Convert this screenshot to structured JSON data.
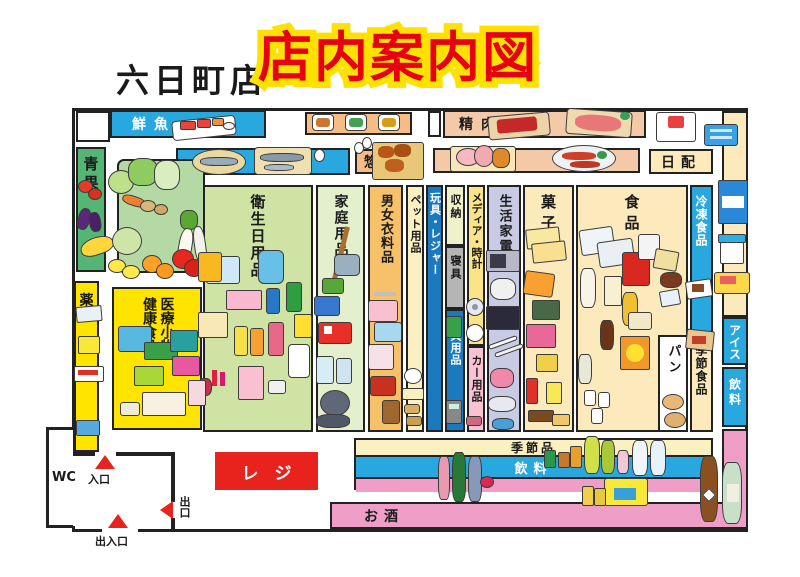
{
  "header": {
    "store_name": "六日町店",
    "title": "店内案内図"
  },
  "departments": {
    "fresh_fish": "鮮魚",
    "produce": "青果",
    "meat": "精肉",
    "deli": "惣菜",
    "daily_goods": "日配",
    "drug": "薬",
    "medical_line1": "医療小物",
    "medical_line2": "健康食品",
    "hygiene": "衛生日用品",
    "household": "家庭用品",
    "clothing": "男女衣料品",
    "pet": "ペット用品",
    "toys_leisure": "玩具・レジャー",
    "storage": "収納",
    "bedding": "寝具",
    "stationery": "文具用品",
    "media_clocks": "メディア・時計",
    "car_goods": "カー用品",
    "appliances": "生活家電",
    "sweets": "菓子",
    "food": "食品",
    "bread": "パン",
    "frozen_food": "冷凍食品",
    "seasonal_food": "季節食品",
    "ice_cream": "アイス",
    "drinks_side": "飲料",
    "seasonal_items": "季節品",
    "drinks_front": "飲料",
    "alcohol": "お酒"
  },
  "facilities": {
    "register": "レジ",
    "wc": "WC",
    "entrance": "入口",
    "exit": "出口",
    "entrance_exit": "出入口"
  },
  "colors": {
    "title_red": "#e60012",
    "title_outline_yellow": "#ffe100",
    "register_red": "#e8231e",
    "blue": "#29a8e0",
    "deep_blue": "#1b79be",
    "green": "#55b574",
    "yellow": "#ffe400",
    "pink": "#ef9ec7",
    "salmon": "#f3c9a8",
    "cream": "#fdeabc"
  }
}
